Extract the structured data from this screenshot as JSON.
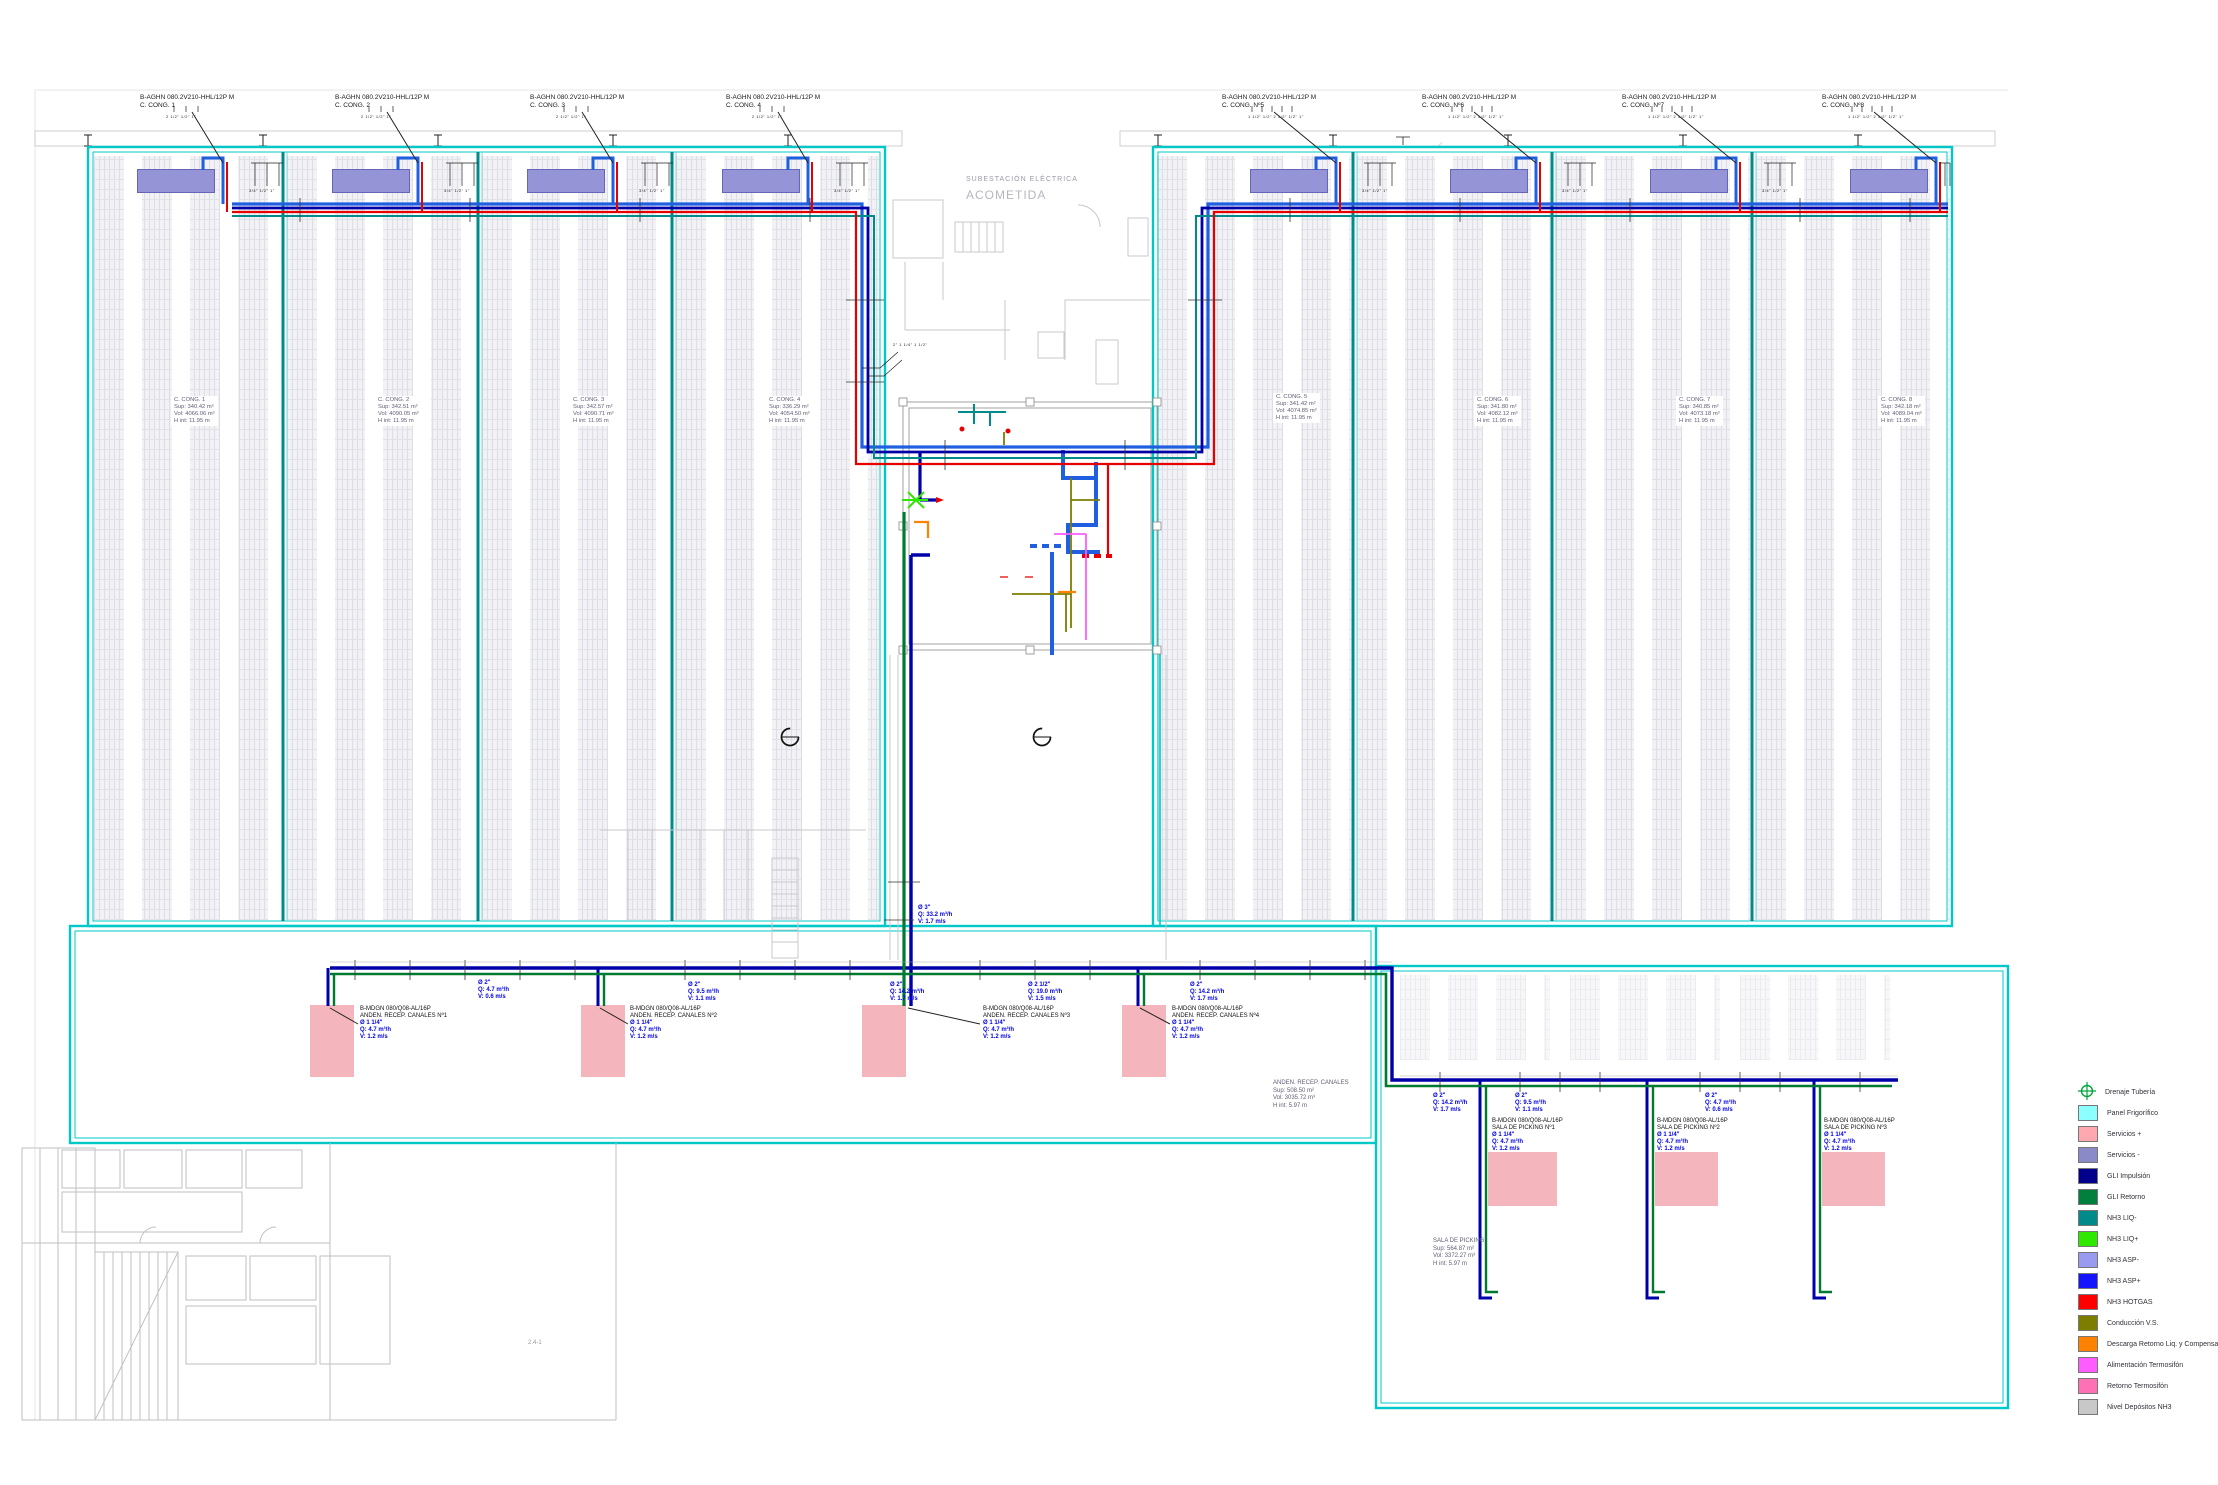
{
  "titles": {
    "substation_line1": "SUBESTACIÓN ELÉCTRICA",
    "substation_line2": "ACOMETIDA",
    "sheet_note": "2.4-1",
    "riser_size_note": "2\" 1 1/4\" 1 1/2\""
  },
  "evap_units": [
    {
      "model": "B-AGHN 080.2V210-HHL/12P M",
      "name": "C. CONG. 1",
      "sizes_a": "2 1/2\" 1/2\" 1\"",
      "sizes_b": "3/4\" 1/2\" 1\""
    },
    {
      "model": "B-AGHN 080.2V210-HHL/12P M",
      "name": "C. CONG. 2",
      "sizes_a": "2 1/2\" 1/2\" 1\"",
      "sizes_b": "3/4\" 1/2\" 1\""
    },
    {
      "model": "B-AGHN 080.2V210-HHL/12P M",
      "name": "C. CONG. 3",
      "sizes_a": "2 1/2\" 1/2\" 1\"",
      "sizes_b": "3/4\" 1/2\" 1\""
    },
    {
      "model": "B-AGHN 080.2V210-HHL/12P M",
      "name": "C. CONG. 4",
      "sizes_a": "2 1/2\" 1/2\" 1\"",
      "sizes_b": "3/4\" 1/2\" 1\""
    },
    {
      "model": "B-AGHN 080.2V210-HHL/12P M",
      "name": "C. CONG. Nº5",
      "sizes_a": "1 1/2\" 1/2\" 2 1/2\" 1/2\" 1\"",
      "sizes_b": "3/4\" 1/2\" 1\""
    },
    {
      "model": "B-AGHN 080.2V210-HHL/12P M",
      "name": "C. CONG. Nº6",
      "sizes_a": "1 1/2\" 1/2\" 2 1/2\" 1/2\" 1\"",
      "sizes_b": "3/4\" 1/2\" 1\""
    },
    {
      "model": "B-AGHN 080.2V210-HHL/12P M",
      "name": "C. CONG. Nº7",
      "sizes_a": "1 1/2\" 1/2\" 2 1/2\" 1/2\" 1\"",
      "sizes_b": "3/4\" 1/2\" 1\""
    },
    {
      "model": "B-AGHN 080.2V210-HHL/12P M",
      "name": "C. CONG. Nº8",
      "sizes_a": "1 1/2\" 1/2\" 2 1/2\" 1/2\" 1\"",
      "sizes_b": "3/4\" 1/2\" 1\""
    }
  ],
  "chambers": [
    {
      "name": "C. CONG. 1",
      "sup": "Sup: 340.42 m²",
      "vol": "Vol: 4066.06 m³",
      "h": "H int: 11.95 m"
    },
    {
      "name": "C. CONG. 2",
      "sup": "Sup: 342.51 m²",
      "vol": "Vol: 4090.05 m³",
      "h": "H int: 11.95 m"
    },
    {
      "name": "C. CONG. 3",
      "sup": "Sup: 342.57 m²",
      "vol": "Vol: 4090.71 m³",
      "h": "H int: 11.95 m"
    },
    {
      "name": "C. CONG. 4",
      "sup": "Sup: 336.29 m²",
      "vol": "Vol: 4054.50 m³",
      "h": "H int: 11.95 m"
    },
    {
      "name": "C. CONG. 5",
      "sup": "Sup: 341.42 m²",
      "vol": "Vol: 4074.85 m³",
      "h": "H int: 11.95 m"
    },
    {
      "name": "C. CONG. 6",
      "sup": "Sup: 341.80 m²",
      "vol": "Vol: 4082.12 m³",
      "h": "H int: 11.95 m"
    },
    {
      "name": "C. CONG. 7",
      "sup": "Sup: 340.85 m²",
      "vol": "Vol: 4073.18 m³",
      "h": "H int: 11.95 m"
    },
    {
      "name": "C. CONG. 8",
      "sup": "Sup: 342.18 m²",
      "vol": "Vol: 4089.04 m³",
      "h": "H int: 11.95 m"
    }
  ],
  "areas": {
    "anden": {
      "name": "ANDEN. RECEP. CANALES",
      "sup": "Sup: 508.50 m²",
      "vol": "Vol: 3035.72 m³",
      "h": "H int: 5.97 m"
    },
    "picking": {
      "name": "SALA DE PICKING",
      "sup": "Sup: 564.87 m²",
      "vol": "Vol: 3372.27 m³",
      "h": "H int: 5.97 m"
    }
  },
  "floor_units": [
    {
      "model": "B-MDGN 080/Q08-AL/16P",
      "name": "ANDEN. RECEP. CANALES Nº1",
      "d": "Ø 1 1/4\"",
      "q": "Q: 4.7 m³/h",
      "v": "V: 1.2 m/s"
    },
    {
      "model": "B-MDGN 080/Q08-AL/16P",
      "name": "ANDEN. RECEP. CANALES Nº2",
      "d": "Ø 1 1/4\"",
      "q": "Q: 4.7 m³/h",
      "v": "V: 1.2 m/s"
    },
    {
      "model": "B-MDGN 080/Q08-AL/16P",
      "name": "ANDEN. RECEP. CANALES Nº3",
      "d": "Ø 1 1/4\"",
      "q": "Q: 4.7 m³/h",
      "v": "V: 1.2 m/s"
    },
    {
      "model": "B-MDGN 080/Q08-AL/16P",
      "name": "ANDEN. RECEP. CANALES Nº4",
      "d": "Ø 1 1/4\"",
      "q": "Q: 4.7 m³/h",
      "v": "V: 1.2 m/s"
    },
    {
      "model": "B-MDGN 080/Q08-AL/16P",
      "name": "SALA DE PICKING Nº1",
      "d": "Ø 1 1/4\"",
      "q": "Q: 4.7 m³/h",
      "v": "V: 1.2 m/s"
    },
    {
      "model": "B-MDGN 080/Q08-AL/16P",
      "name": "SALA DE PICKING Nº2",
      "d": "Ø 1 1/4\"",
      "q": "Q: 4.7 m³/h",
      "v": "V: 1.2 m/s"
    },
    {
      "model": "B-MDGN 080/Q08-AL/16P",
      "name": "SALA DE PICKING Nº3",
      "d": "Ø 1 1/4\"",
      "q": "Q: 4.7 m³/h",
      "v": "V: 1.2 m/s"
    }
  ],
  "pipe_labels": [
    {
      "d": "Ø 2\"",
      "q": "Q: 4.7 m³/h",
      "v": "V: 0.6 m/s"
    },
    {
      "d": "Ø 2\"",
      "q": "Q: 9.5 m³/h",
      "v": "V: 1.1 m/s"
    },
    {
      "d": "Ø 2\"",
      "q": "Q: 14.2 m³/h",
      "v": "V: 1.7 m/s"
    },
    {
      "d": "Ø 2 1/2\"",
      "q": "Q: 19.0 m³/h",
      "v": "V: 1.5 m/s"
    },
    {
      "d": "Ø 2\"",
      "q": "Q: 14.2 m³/h",
      "v": "V: 1.7 m/s"
    },
    {
      "d": "Ø 3\"",
      "q": "Q: 33.2 m³/h",
      "v": "V: 1.7 m/s"
    },
    {
      "d": "Ø 2\"",
      "q": "Q: 14.2 m³/h",
      "v": "V: 1.7 m/s"
    },
    {
      "d": "Ø 2\"",
      "q": "Q: 9.5 m³/h",
      "v": "V: 1.1 m/s"
    },
    {
      "d": "Ø 2\"",
      "q": "Q: 4.7 m³/h",
      "v": "V: 0.6 m/s"
    }
  ],
  "legend": {
    "items": [
      {
        "label": "Drenaje Tubería",
        "color": "icon-drain"
      },
      {
        "label": "Panel Frigorífico",
        "color": "#8cffff"
      },
      {
        "label": "Servicios +",
        "color": "#ffa8b0"
      },
      {
        "label": "Servicios -",
        "color": "#8a8ac8"
      },
      {
        "label": "GLI Impulsión",
        "color": "#00008b"
      },
      {
        "label": "GLI Retorno",
        "color": "#00803c"
      },
      {
        "label": "NH3 LIQ-",
        "color": "#008b8b"
      },
      {
        "label": "NH3 LIQ+",
        "color": "#2ee800"
      },
      {
        "label": "NH3 ASP-",
        "color": "#9a9af0"
      },
      {
        "label": "NH3 ASP+",
        "color": "#1414ff"
      },
      {
        "label": "NH3 HOTGAS",
        "color": "#ff0000"
      },
      {
        "label": "Conducción V.S.",
        "color": "#7d7d00"
      },
      {
        "label": "Descarga Retorno Liq. y Compensación",
        "color": "#ff8200"
      },
      {
        "label": "Alimentación Termosifón",
        "color": "#ff5cff"
      },
      {
        "label": "Retorno Termosifón",
        "color": "#ff70b4"
      },
      {
        "label": "Nivel Depósitos NH3",
        "color": "#c8c8c8"
      }
    ]
  },
  "colors": {
    "wall_cyan": "#00c8c8",
    "partition": "#008a8a",
    "asp_blue": "#2060e0",
    "gli_imp": "#0000a8",
    "gli_ret": "#007a30",
    "liq_teal": "#008b8b",
    "hotgas_red": "#e60000",
    "evap": "#9494d6",
    "servicios_pink": "#f5b5bc"
  }
}
